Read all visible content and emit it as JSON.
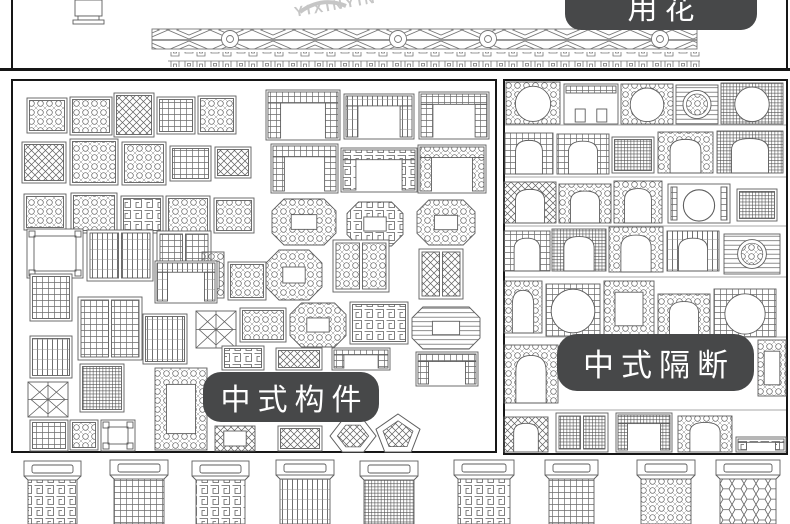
{
  "image": {
    "width": 790,
    "height": 524,
    "bg": "#ffffff",
    "ink": "#5e5e5e",
    "border": "#161616"
  },
  "badges": {
    "bg": "#474849",
    "fg": "#ffffff",
    "top_right": {
      "text": "用花",
      "x": 565,
      "y": -24,
      "w": 192,
      "h": 52,
      "r": 16,
      "font": 30
    },
    "left_panel": {
      "text": "中式构件",
      "x": 203,
      "y": 372,
      "w": 176,
      "h": 50,
      "r": 18,
      "font": 30
    },
    "right_panel": {
      "text": "中式隔断",
      "x": 557,
      "y": 334,
      "w": 197,
      "h": 57,
      "r": 20,
      "font": 31
    }
  },
  "watermark": {
    "text": "YIXINYIN",
    "color": "#c6c6c6",
    "x": 293,
    "y": 4,
    "rotate": -10,
    "font": 14,
    "spacing": 3
  },
  "top_strip": {
    "h": 70,
    "vase": {
      "x": 75,
      "y": 0,
      "w": 27,
      "h": 24
    },
    "railing": {
      "bandA": {
        "x": 152,
        "y": 29,
        "w": 545,
        "h": 20,
        "medallions": [
          230,
          398,
          488,
          660
        ]
      },
      "bandB": {
        "x": 168,
        "y": 52,
        "w": 532,
        "h": 15
      }
    }
  },
  "panels": {
    "left": {
      "x": 11,
      "y": 79,
      "w": 486,
      "h": 374,
      "items": [
        {
          "t": "lattice",
          "p": "scroll",
          "x": 27,
          "y": 98,
          "w": 40,
          "h": 35
        },
        {
          "t": "lattice",
          "p": "scroll",
          "x": 70,
          "y": 97,
          "w": 42,
          "h": 38
        },
        {
          "t": "lattice",
          "p": "diag",
          "x": 114,
          "y": 93,
          "w": 40,
          "h": 44
        },
        {
          "t": "lattice",
          "p": "grid",
          "x": 157,
          "y": 97,
          "w": 38,
          "h": 37
        },
        {
          "t": "lattice",
          "p": "scroll",
          "x": 198,
          "y": 96,
          "w": 38,
          "h": 38
        },
        {
          "t": "window",
          "p": "grid",
          "x": 266,
          "y": 90,
          "w": 74,
          "h": 50
        },
        {
          "t": "window",
          "p": "slats",
          "x": 344,
          "y": 94,
          "w": 70,
          "h": 45
        },
        {
          "t": "window",
          "p": "grid",
          "x": 419,
          "y": 92,
          "w": 70,
          "h": 47
        },
        {
          "t": "lattice",
          "p": "diag",
          "x": 22,
          "y": 142,
          "w": 44,
          "h": 41
        },
        {
          "t": "lattice",
          "p": "scroll",
          "x": 70,
          "y": 139,
          "w": 48,
          "h": 46
        },
        {
          "t": "lattice",
          "p": "scroll",
          "x": 122,
          "y": 142,
          "w": 44,
          "h": 43
        },
        {
          "t": "lattice",
          "p": "grid",
          "x": 170,
          "y": 146,
          "w": 41,
          "h": 35
        },
        {
          "t": "lattice",
          "p": "diag",
          "x": 215,
          "y": 147,
          "w": 36,
          "h": 31
        },
        {
          "t": "window",
          "p": "grid",
          "x": 271,
          "y": 144,
          "w": 67,
          "h": 49
        },
        {
          "t": "window",
          "p": "key",
          "x": 341,
          "y": 148,
          "w": 76,
          "h": 44
        },
        {
          "t": "window",
          "p": "scroll",
          "x": 418,
          "y": 145,
          "w": 68,
          "h": 48
        },
        {
          "t": "lattice",
          "p": "scroll",
          "x": 24,
          "y": 194,
          "w": 42,
          "h": 36
        },
        {
          "t": "lattice",
          "p": "scroll",
          "x": 71,
          "y": 193,
          "w": 46,
          "h": 40
        },
        {
          "t": "lattice",
          "p": "key",
          "x": 121,
          "y": 196,
          "w": 42,
          "h": 37
        },
        {
          "t": "lattice",
          "p": "scroll",
          "x": 166,
          "y": 196,
          "w": 44,
          "h": 38
        },
        {
          "t": "lattice",
          "p": "scroll",
          "x": 214,
          "y": 198,
          "w": 40,
          "h": 35
        },
        {
          "t": "octagon",
          "p": "scroll",
          "x": 272,
          "y": 199,
          "w": 64,
          "h": 46
        },
        {
          "t": "octagon",
          "p": "key",
          "x": 347,
          "y": 202,
          "w": 56,
          "h": 44
        },
        {
          "t": "octagon",
          "p": "scroll",
          "x": 417,
          "y": 200,
          "w": 58,
          "h": 45
        },
        {
          "t": "frame",
          "x": 27,
          "y": 229,
          "w": 56,
          "h": 49
        },
        {
          "t": "doorpair",
          "p": "slats",
          "x": 87,
          "y": 230,
          "w": 66,
          "h": 51
        },
        {
          "t": "doorpair",
          "p": "grid",
          "x": 157,
          "y": 231,
          "w": 54,
          "h": 46
        },
        {
          "t": "bordered",
          "p": "scroll",
          "x": 202,
          "y": 252,
          "w": 22,
          "h": 46
        },
        {
          "t": "lattice",
          "p": "scroll",
          "x": 228,
          "y": 262,
          "w": 38,
          "h": 38
        },
        {
          "t": "octagon",
          "p": "scroll",
          "x": 266,
          "y": 250,
          "w": 56,
          "h": 50
        },
        {
          "t": "doorpair",
          "p": "scroll",
          "x": 333,
          "y": 240,
          "w": 56,
          "h": 52
        },
        {
          "t": "doorpair",
          "p": "diag",
          "x": 419,
          "y": 249,
          "w": 44,
          "h": 50
        },
        {
          "t": "lattice",
          "p": "grid",
          "x": 30,
          "y": 274,
          "w": 42,
          "h": 47
        },
        {
          "t": "doorpair",
          "p": "grid",
          "x": 78,
          "y": 297,
          "w": 64,
          "h": 63
        },
        {
          "t": "window",
          "p": "slats",
          "x": 155,
          "y": 261,
          "w": 62,
          "h": 42
        },
        {
          "t": "lattice",
          "p": "slats",
          "x": 143,
          "y": 314,
          "w": 44,
          "h": 50
        },
        {
          "t": "star",
          "x": 196,
          "y": 311,
          "w": 40,
          "h": 37
        },
        {
          "t": "lattice",
          "p": "scroll",
          "x": 240,
          "y": 308,
          "w": 46,
          "h": 34
        },
        {
          "t": "octagon",
          "p": "scroll",
          "x": 290,
          "y": 303,
          "w": 56,
          "h": 44
        },
        {
          "t": "lattice",
          "p": "key",
          "x": 350,
          "y": 302,
          "w": 58,
          "h": 42
        },
        {
          "t": "octagon",
          "p": "hslats",
          "x": 412,
          "y": 307,
          "w": 68,
          "h": 42
        },
        {
          "t": "lattice",
          "p": "slats",
          "x": 30,
          "y": 336,
          "w": 42,
          "h": 42
        },
        {
          "t": "lattice",
          "p": "dense",
          "x": 80,
          "y": 364,
          "w": 44,
          "h": 48
        },
        {
          "t": "star",
          "x": 28,
          "y": 382,
          "w": 40,
          "h": 35
        },
        {
          "t": "bordered",
          "p": "scroll",
          "x": 155,
          "y": 368,
          "w": 52,
          "h": 82
        },
        {
          "t": "lattice",
          "p": "key",
          "x": 222,
          "y": 346,
          "w": 42,
          "h": 24
        },
        {
          "t": "lattice",
          "p": "diag",
          "x": 276,
          "y": 348,
          "w": 46,
          "h": 22
        },
        {
          "t": "window",
          "p": "grid",
          "x": 332,
          "y": 348,
          "w": 58,
          "h": 22
        },
        {
          "t": "window",
          "p": "grid",
          "x": 416,
          "y": 352,
          "w": 62,
          "h": 34
        },
        {
          "t": "lattice",
          "p": "grid",
          "x": 30,
          "y": 420,
          "w": 38,
          "h": 31
        },
        {
          "t": "lattice",
          "p": "scroll",
          "x": 70,
          "y": 420,
          "w": 28,
          "h": 30
        },
        {
          "t": "frame",
          "x": 101,
          "y": 420,
          "w": 34,
          "h": 31
        },
        {
          "t": "bordered",
          "p": "diag",
          "x": 215,
          "y": 426,
          "w": 40,
          "h": 25
        },
        {
          "t": "lattice",
          "p": "diag",
          "x": 278,
          "y": 426,
          "w": 44,
          "h": 25
        },
        {
          "t": "hex",
          "p": "diag",
          "x": 330,
          "y": 420,
          "w": 46,
          "h": 32
        },
        {
          "t": "pent",
          "p": "diag",
          "x": 376,
          "y": 414,
          "w": 44,
          "h": 38
        }
      ]
    },
    "right": {
      "x": 503,
      "y": 79,
      "w": 285,
      "h": 376,
      "row_lines": [
        125,
        177,
        226,
        277,
        337,
        410
      ],
      "items": [
        {
          "t": "moon",
          "p": "scroll",
          "x": 506,
          "y": 82,
          "w": 54,
          "h": 42
        },
        {
          "t": "room",
          "x": 564,
          "y": 84,
          "w": 54,
          "h": 40
        },
        {
          "t": "moon",
          "p": "scroll",
          "x": 621,
          "y": 84,
          "w": 52,
          "h": 40
        },
        {
          "t": "louver",
          "p": "scroll",
          "x": 676,
          "y": 85,
          "w": 42,
          "h": 39
        },
        {
          "t": "moon",
          "p": "dense",
          "x": 721,
          "y": 83,
          "w": 62,
          "h": 41
        },
        {
          "t": "arch",
          "p": "grid",
          "x": 505,
          "y": 133,
          "w": 48,
          "h": 41
        },
        {
          "t": "arch",
          "p": "grid",
          "x": 557,
          "y": 134,
          "w": 52,
          "h": 40
        },
        {
          "t": "lattice",
          "p": "dense",
          "x": 612,
          "y": 137,
          "w": 42,
          "h": 36
        },
        {
          "t": "arch",
          "p": "scroll",
          "x": 658,
          "y": 132,
          "w": 55,
          "h": 41
        },
        {
          "t": "arch",
          "p": "dense",
          "x": 717,
          "y": 131,
          "w": 66,
          "h": 42
        },
        {
          "t": "arch",
          "p": "diag",
          "x": 504,
          "y": 182,
          "w": 52,
          "h": 41
        },
        {
          "t": "arch",
          "p": "scroll",
          "x": 559,
          "y": 184,
          "w": 52,
          "h": 39
        },
        {
          "t": "arch",
          "p": "scroll",
          "x": 614,
          "y": 181,
          "w": 48,
          "h": 42
        },
        {
          "t": "ring",
          "x": 668,
          "y": 184,
          "w": 62,
          "h": 39
        },
        {
          "t": "lattice",
          "p": "dense",
          "x": 737,
          "y": 189,
          "w": 40,
          "h": 32
        },
        {
          "t": "arch",
          "p": "grid",
          "x": 504,
          "y": 231,
          "w": 46,
          "h": 40
        },
        {
          "t": "arch",
          "p": "dense",
          "x": 552,
          "y": 229,
          "w": 54,
          "h": 42
        },
        {
          "t": "arch",
          "p": "scroll",
          "x": 609,
          "y": 227,
          "w": 54,
          "h": 45
        },
        {
          "t": "arch",
          "p": "slats",
          "x": 667,
          "y": 231,
          "w": 52,
          "h": 40
        },
        {
          "t": "louver",
          "p": "scroll",
          "x": 724,
          "y": 234,
          "w": 56,
          "h": 40
        },
        {
          "t": "arch",
          "p": "scroll",
          "x": 504,
          "y": 281,
          "w": 38,
          "h": 52
        },
        {
          "t": "moon",
          "p": "grid",
          "x": 546,
          "y": 284,
          "w": 54,
          "h": 52
        },
        {
          "t": "bordered",
          "p": "scroll",
          "x": 604,
          "y": 281,
          "w": 50,
          "h": 56
        },
        {
          "t": "arch",
          "p": "scroll",
          "x": 658,
          "y": 294,
          "w": 52,
          "h": 42
        },
        {
          "t": "moon",
          "p": "grid",
          "x": 714,
          "y": 289,
          "w": 62,
          "h": 48
        },
        {
          "t": "arch",
          "p": "scroll",
          "x": 504,
          "y": 345,
          "w": 54,
          "h": 58
        },
        {
          "t": "bordered",
          "p": "scroll",
          "x": 758,
          "y": 340,
          "w": 28,
          "h": 56
        },
        {
          "t": "arch",
          "p": "diag",
          "x": 504,
          "y": 417,
          "w": 44,
          "h": 35
        },
        {
          "t": "doorpair",
          "p": "dense",
          "x": 556,
          "y": 413,
          "w": 52,
          "h": 39
        },
        {
          "t": "window",
          "p": "dense",
          "x": 616,
          "y": 413,
          "w": 56,
          "h": 39
        },
        {
          "t": "arch",
          "p": "scroll",
          "x": 678,
          "y": 416,
          "w": 54,
          "h": 36
        },
        {
          "t": "window",
          "p": "key",
          "x": 736,
          "y": 437,
          "w": 50,
          "h": 15
        }
      ]
    },
    "bottom": {
      "y": 455,
      "items": [
        {
          "t": "door",
          "p": "key",
          "x": 22,
          "y": 459,
          "w": 61,
          "h": 65
        },
        {
          "t": "door",
          "p": "grid",
          "x": 108,
          "y": 458,
          "w": 62,
          "h": 66
        },
        {
          "t": "door",
          "p": "key",
          "x": 190,
          "y": 459,
          "w": 61,
          "h": 65
        },
        {
          "t": "door",
          "p": "slats",
          "x": 274,
          "y": 458,
          "w": 62,
          "h": 66
        },
        {
          "t": "door",
          "p": "dense",
          "x": 358,
          "y": 459,
          "w": 62,
          "h": 65
        },
        {
          "t": "door",
          "p": "key",
          "x": 452,
          "y": 458,
          "w": 64,
          "h": 66
        },
        {
          "t": "door",
          "p": "grid",
          "x": 543,
          "y": 458,
          "w": 57,
          "h": 66
        },
        {
          "t": "door",
          "p": "scroll",
          "x": 635,
          "y": 458,
          "w": 62,
          "h": 66
        },
        {
          "t": "door",
          "p": "hex",
          "x": 714,
          "y": 458,
          "w": 68,
          "h": 66
        }
      ]
    }
  }
}
